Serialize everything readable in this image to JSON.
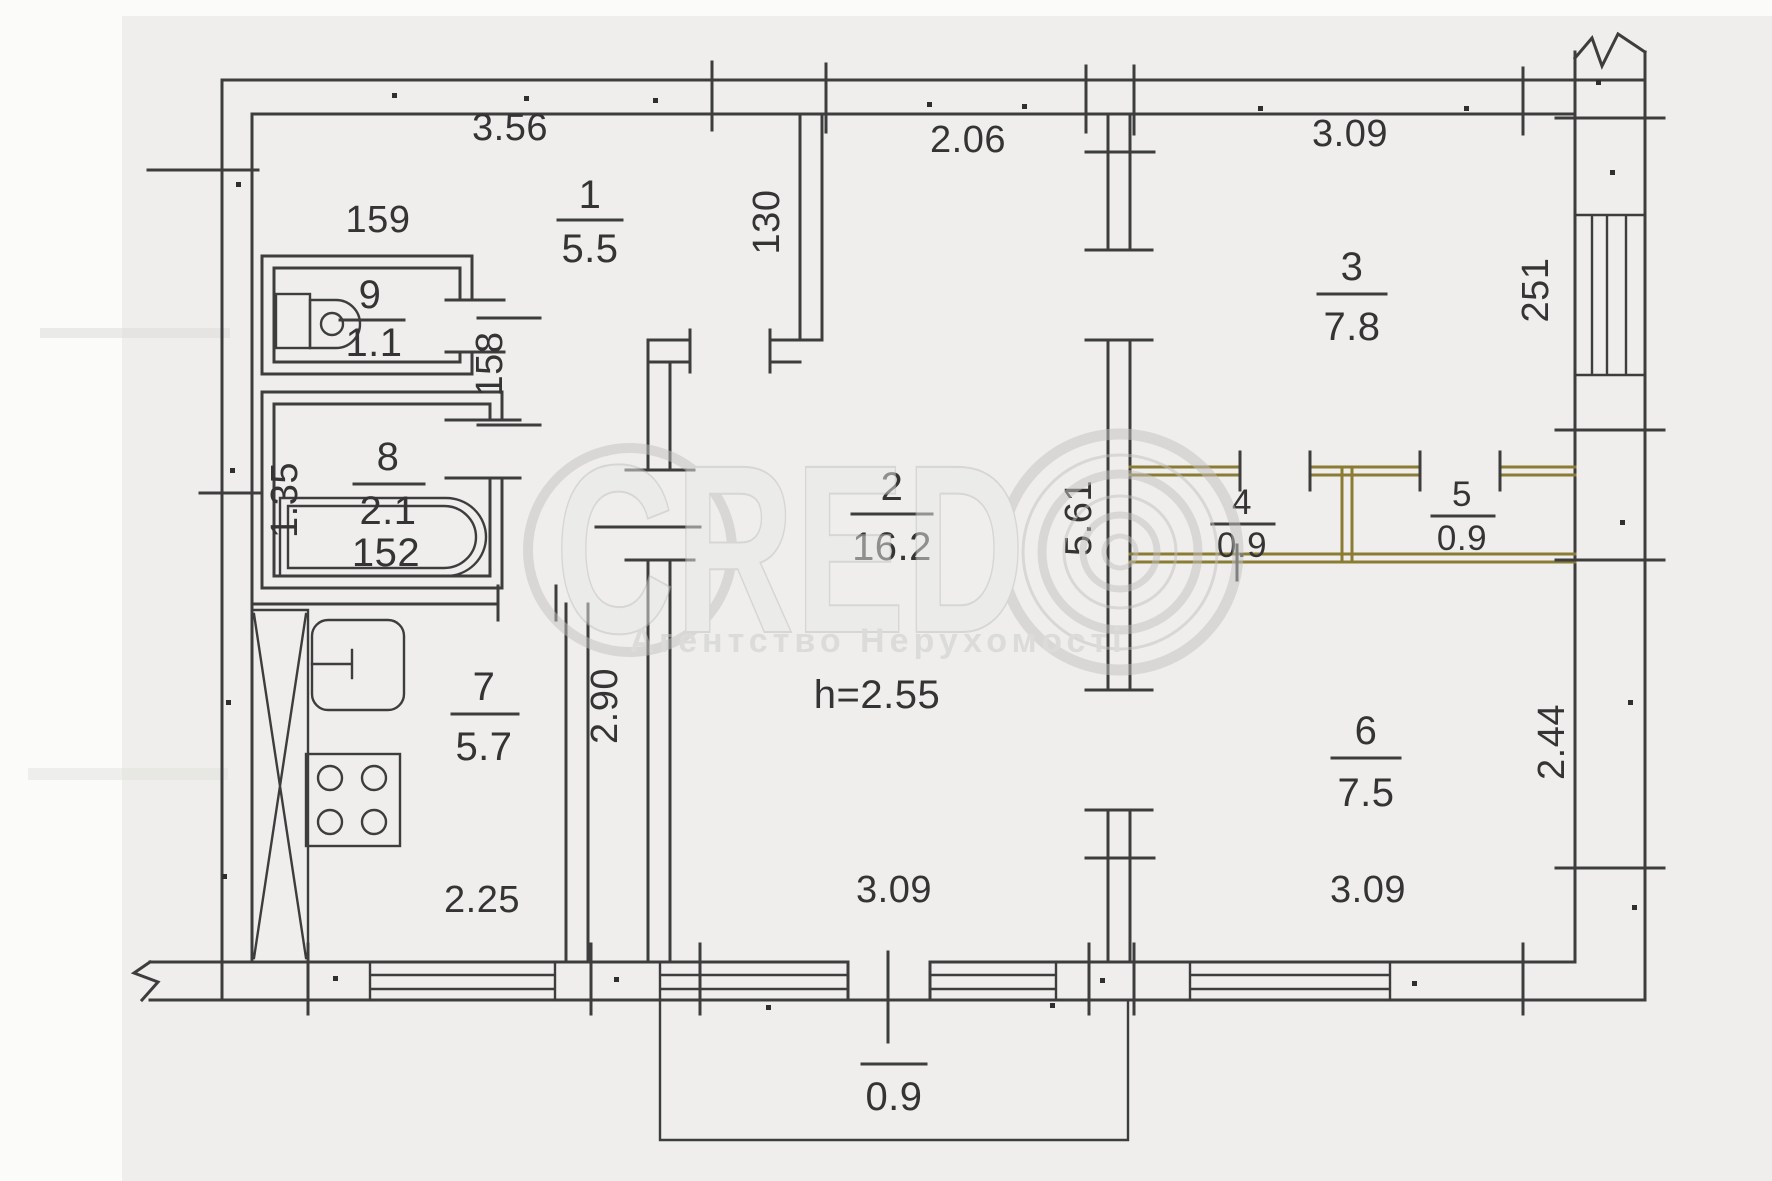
{
  "plan": {
    "type": "apartment-floor-plan",
    "watermark": {
      "brand": "CRED",
      "tagline": "Агентство Нерухомості"
    },
    "ceiling_height": "h=2.55",
    "rooms": [
      {
        "number": "1",
        "area": "5.5"
      },
      {
        "number": "2",
        "area": "16.2"
      },
      {
        "number": "3",
        "area": "7.8"
      },
      {
        "number": "4",
        "area": "0.9"
      },
      {
        "number": "5",
        "area": "0.9"
      },
      {
        "number": "6",
        "area": "7.5"
      },
      {
        "number": "7",
        "area": "5.7"
      },
      {
        "number": "8",
        "area": "2.1",
        "width_note": "152"
      },
      {
        "number": "9",
        "area": "1.1"
      },
      {
        "number": "balcony",
        "area": "0.9"
      }
    ],
    "dimensions": {
      "hall_top": "3.56",
      "room9_width": "159",
      "hall_right": "130",
      "room2_top": "2.06",
      "room3_top": "3.09",
      "corridor": "158",
      "room8_left": "1.35",
      "kitchen_right": "2.90",
      "room2_right": "5.61",
      "loggia_right": "251",
      "room6_right": "2.44",
      "kitchen_bottom": "2.25",
      "room2_bottom": "3.09",
      "room6_bottom": "3.09",
      "balcony_depth": "0.9"
    },
    "colors": {
      "line": "#3d3d3d",
      "closet": "#8b7c33",
      "paper": "#efeeec",
      "watermark": "#c2c2c0"
    }
  }
}
